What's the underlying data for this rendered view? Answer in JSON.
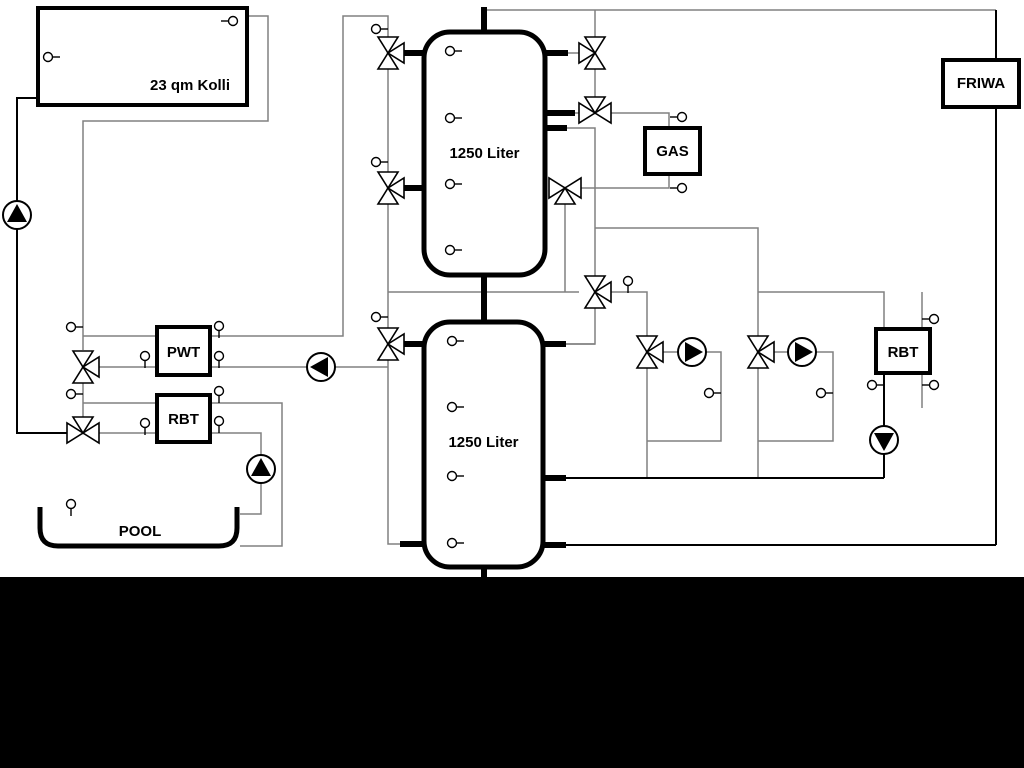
{
  "diagram": {
    "labels": {
      "collector": "23 qm Kolli",
      "tank_upper": "1250 Liter",
      "tank_lower": "1250 Liter",
      "gas": "GAS",
      "friwa": "FRIWA",
      "pwt": "PWT",
      "rbt_left": "RBT",
      "rbt_right": "RBT",
      "pool": "POOL"
    },
    "colors": {
      "pipe_gray": "#808080",
      "pipe_black": "#000000",
      "component_outline": "#000000",
      "background": "#ffffff",
      "footer_band": "#000000"
    }
  }
}
